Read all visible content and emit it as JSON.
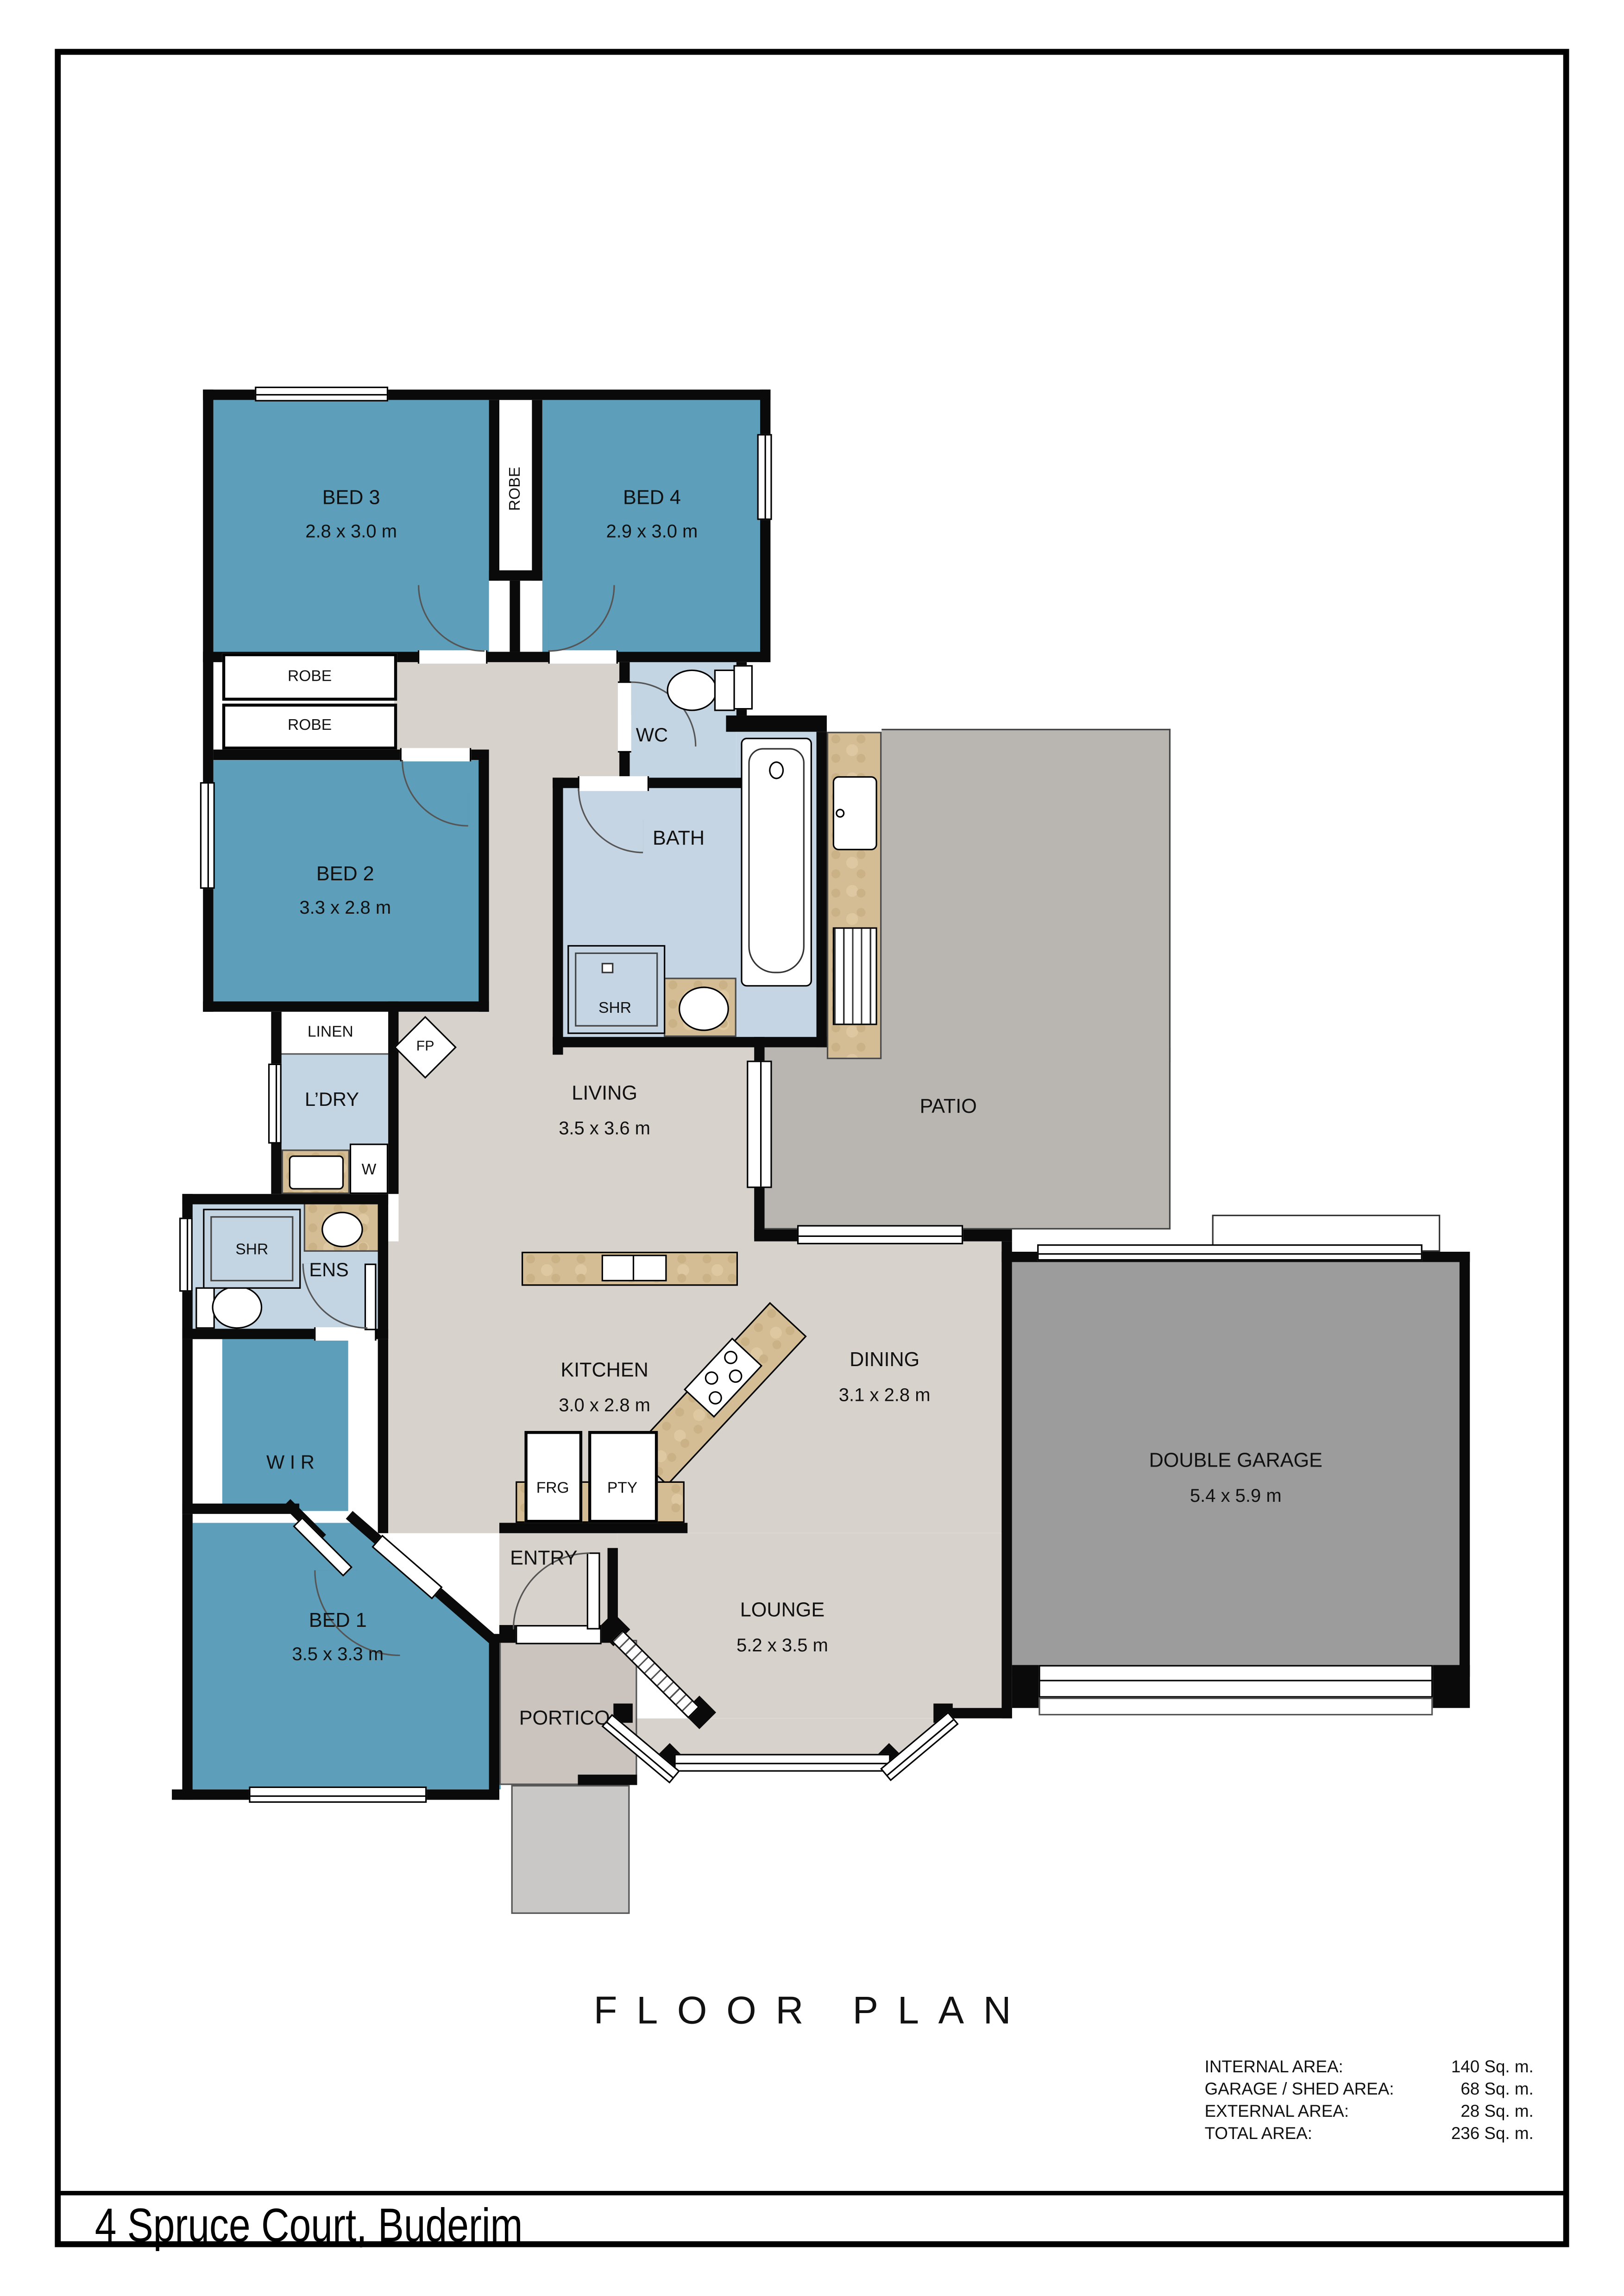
{
  "page": {
    "floor_plan_title": "FLOOR PLAN",
    "address": "4 Spruce Court, Buderim"
  },
  "area_table": {
    "rows": [
      {
        "label": "INTERNAL AREA:",
        "value": "140 Sq. m."
      },
      {
        "label": "GARAGE / SHED AREA:",
        "value": "68 Sq. m."
      },
      {
        "label": "EXTERNAL AREA:",
        "value": "28 Sq. m."
      },
      {
        "label": "TOTAL AREA:",
        "value": "236 Sq. m."
      }
    ]
  },
  "rooms": {
    "bed1": {
      "name": "BED 1",
      "dims": "3.5 x 3.3 m"
    },
    "bed2": {
      "name": "BED 2",
      "dims": "3.3 x 2.8 m"
    },
    "bed3": {
      "name": "BED 3",
      "dims": "2.8 x 3.0 m"
    },
    "bed4": {
      "name": "BED 4",
      "dims": "2.9 x 3.0 m"
    },
    "living": {
      "name": "LIVING",
      "dims": "3.5 x 3.6 m"
    },
    "kitchen": {
      "name": "KITCHEN",
      "dims": "3.0 x 2.8 m"
    },
    "dining": {
      "name": "DINING",
      "dims": "3.1 x 2.8 m"
    },
    "lounge": {
      "name": "LOUNGE",
      "dims": "5.2 x 3.5 m"
    },
    "garage": {
      "name": "DOUBLE GARAGE",
      "dims": "5.4 x 5.9 m"
    },
    "patio": {
      "name": "PATIO"
    },
    "entry": {
      "name": "ENTRY"
    },
    "portico": {
      "name": "PORTICO"
    },
    "bath": {
      "name": "BATH"
    },
    "wc": {
      "name": "WC"
    },
    "ens": {
      "name": "ENS"
    },
    "wir": {
      "name": "W I R"
    },
    "ldry": {
      "name": "L’DRY"
    },
    "linen": {
      "name": "LINEN"
    }
  },
  "fixtures": {
    "robe": "ROBE",
    "shr": "SHR",
    "fp": "FP",
    "frg": "FRG",
    "pty": "PTY",
    "washer": "W"
  }
}
